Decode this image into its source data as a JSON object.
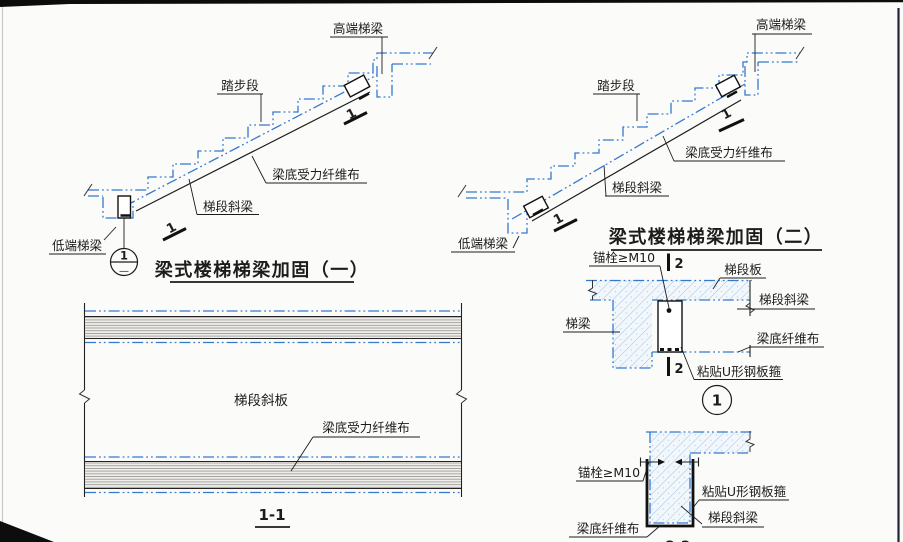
{
  "colors": {
    "blue": "#3579cf",
    "ink": "#1c1c1c",
    "hatch": "#a3c1e0"
  },
  "d1": {
    "title": "梁式楼梯梯梁加固（一）",
    "high_beam": "高端梯梁",
    "tread": "踏步段",
    "fiber": "梁底受力纤维布",
    "incline_beam": "梯段斜梁",
    "low_beam": "低端梯梁",
    "section_mark": "1",
    "callout_num": "1",
    "callout_sheet": "—"
  },
  "d2": {
    "title": "梁式楼梯梯梁加固（二）",
    "high_beam": "高端梯梁",
    "tread": "踏步段",
    "fiber": "梁底受力纤维布",
    "incline_beam": "梯段斜梁",
    "low_beam": "低端梯梁",
    "section_mark": "1"
  },
  "s11": {
    "title": "1-1",
    "slab": "梯段斜板",
    "fiber": "梁底受力纤维布"
  },
  "dt1": {
    "callout_num": "1",
    "section_mark": "2",
    "anchor": "锚栓≥M10",
    "slab": "梯段板",
    "incline_beam": "梯段斜梁",
    "beam": "梯梁",
    "fiber": "梁底纤维布",
    "u_plate": "粘贴U形钢板箍"
  },
  "s22": {
    "title": "2-2",
    "anchor": "锚栓≥M10",
    "u_plate": "粘贴U形钢板箍",
    "incline_beam": "梯段斜梁",
    "fiber": "梁底纤维布"
  }
}
